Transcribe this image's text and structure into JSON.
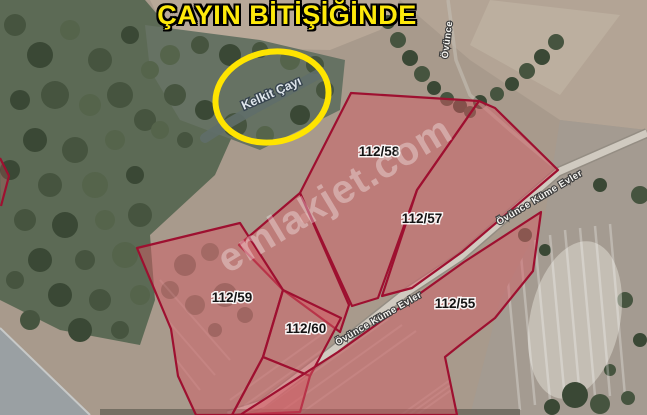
{
  "title": {
    "text": "ÇAYIN BİTİŞİĞİNDE"
  },
  "highlight": {
    "stream_name": "Kelkit Çayı"
  },
  "watermark": {
    "text": "emlakjet.com"
  },
  "map": {
    "type": "satellite-parcel-overlay",
    "road_name": "Övünce Küme Evler",
    "road_name_fragment": "Övünce",
    "parcels": [
      {
        "id": "112/58"
      },
      {
        "id": "112/57"
      },
      {
        "id": "112/59"
      },
      {
        "id": "112/60"
      },
      {
        "id": "112/55"
      }
    ],
    "colors": {
      "headline_yellow": "#fde90b",
      "highlight_circle_yellow": "#ffe400",
      "parcel_boundary_red": "#9e1030",
      "parcel_fill_pink": "rgba(214,92,101,0.48)",
      "road_grey": "#d0cac0",
      "forest_green": "#5c6a55"
    }
  }
}
